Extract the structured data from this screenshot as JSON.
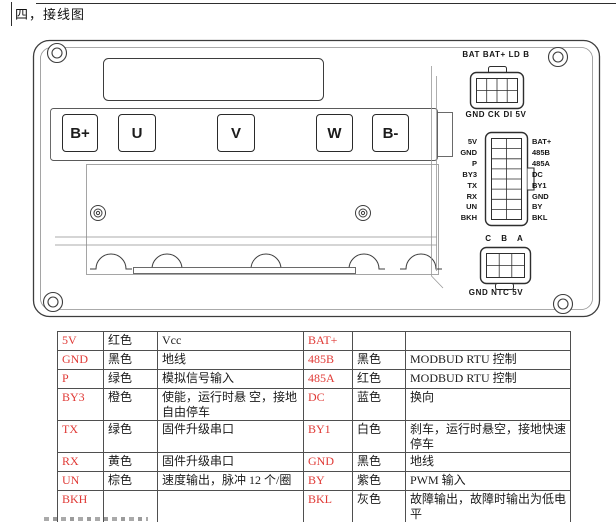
{
  "page": {
    "title": "四，接线图"
  },
  "diagram": {
    "terminals": [
      "B+",
      "U",
      "V",
      "W",
      "B-"
    ],
    "top_connector": {
      "label_top": "BAT BAT+ LD B",
      "label_bottom": "GND CK DI 5V"
    },
    "middle_connector": {
      "left_pins": [
        "5V",
        "GND",
        "P",
        "BY3",
        "TX",
        "RX",
        "UN",
        "BKH"
      ],
      "right_pins": [
        "BAT+",
        "485B",
        "485A",
        "DC",
        "BY1",
        "GND",
        "BY",
        "BKL"
      ]
    },
    "bottom_connector": {
      "label_top": "C B A",
      "label_bottom": "GND NTC 5V"
    }
  },
  "wiring_table": {
    "rows": [
      {
        "l_pin": "5V",
        "l_color": "红色",
        "l_desc": "Vcc",
        "r_pin": "BAT+",
        "r_color": "",
        "r_desc": ""
      },
      {
        "l_pin": "GND",
        "l_color": "黑色",
        "l_desc": "地线",
        "r_pin": "485B",
        "r_color": "黑色",
        "r_desc": "MODBUD RTU 控制"
      },
      {
        "l_pin": "P",
        "l_color": "绿色",
        "l_desc": "模拟信号输入",
        "r_pin": "485A",
        "r_color": "红色",
        "r_desc": "MODBUD RTU 控制"
      },
      {
        "l_pin": "BY3",
        "l_color": "橙色",
        "l_desc": "使能，运行时悬 空，接地自由停车",
        "r_pin": "DC",
        "r_color": "蓝色",
        "r_desc": "换向"
      },
      {
        "l_pin": "TX",
        "l_color": "绿色",
        "l_desc": "固件升级串口",
        "r_pin": "BY1",
        "r_color": "白色",
        "r_desc": "刹车，运行时悬空，接地快速停车"
      },
      {
        "l_pin": "RX",
        "l_color": "黄色",
        "l_desc": "固件升级串口",
        "r_pin": "GND",
        "r_color": "黑色",
        "r_desc": "地线"
      },
      {
        "l_pin": "UN",
        "l_color": "棕色",
        "l_desc": "速度输出，脉冲 12 个/圈",
        "r_pin": "BY",
        "r_color": "紫色",
        "r_desc": "PWM 输入"
      },
      {
        "l_pin": "BKH",
        "l_color": "",
        "l_desc": "",
        "r_pin": "BKL",
        "r_color": "灰色",
        "r_desc": "故障输出，故障时输出为低电平"
      }
    ]
  },
  "colors": {
    "pin_text": "#e03a36",
    "table_border": "#4f4f4f",
    "drawing_line": "#2e2e2e"
  }
}
